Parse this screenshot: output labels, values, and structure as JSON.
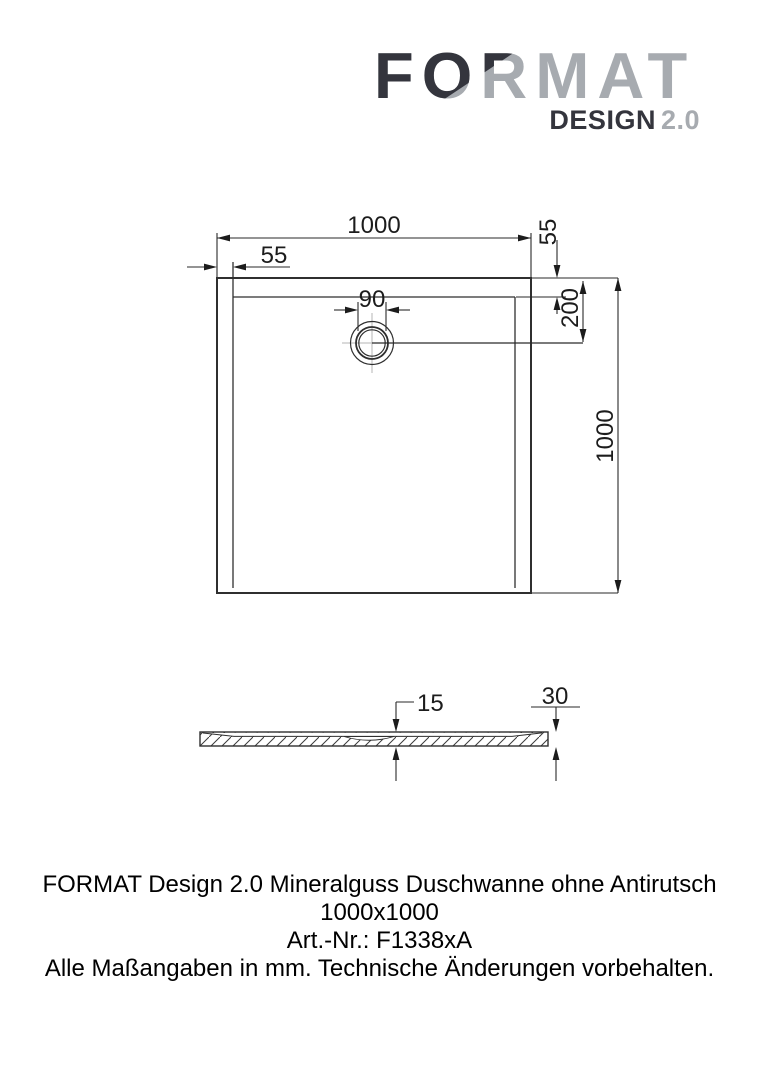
{
  "logo": {
    "brand": "FORMAT",
    "sub_brand": "DESIGN",
    "sub_version": "2.0",
    "dark_color": "#34353d",
    "light_color": "#a7abb0"
  },
  "plan": {
    "dim_width_top": "1000",
    "dim_rim_left": "55",
    "dim_rim_right": "55",
    "dim_drain_diameter": "90",
    "dim_drain_offset": "200",
    "dim_height_right": "1000"
  },
  "section": {
    "dim_inner_depth": "15",
    "dim_total_height": "30"
  },
  "footer": {
    "line1": "FORMAT Design 2.0 Mineralguss Duschwanne ohne Antirutsch 1000x1000",
    "line2": "Art.-Nr.: F1338xA",
    "line3": "Alle Maßangaben in mm. Technische Änderungen vorbehalten."
  }
}
